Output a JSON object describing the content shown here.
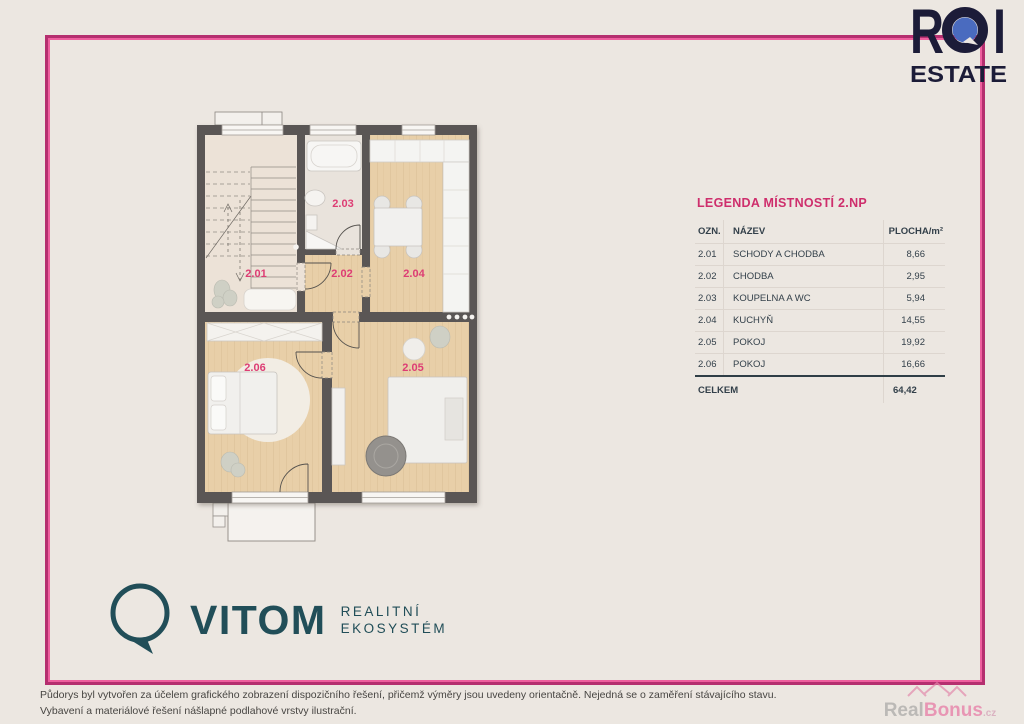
{
  "branding": {
    "roi": {
      "word": "ROI",
      "letter_r": "R",
      "letter_i": "I",
      "line2": "ESTATE"
    },
    "vitom": {
      "name": "VITOM",
      "tagline_line1": "REALITNÍ",
      "tagline_line2": "EKOSYSTÉM"
    },
    "watermark": {
      "part1": "Real",
      "part2": "Bonus",
      "suffix": ".cz"
    }
  },
  "legend": {
    "title": "LEGENDA MÍSTNOSTÍ 2.NP",
    "columns": {
      "code": "OZN.",
      "name": "NÁZEV",
      "area": "PLOCHA/m²"
    },
    "rows": [
      {
        "code": "2.01",
        "name": "SCHODY A CHODBA",
        "area": "8,66"
      },
      {
        "code": "2.02",
        "name": "CHODBA",
        "area": "2,95"
      },
      {
        "code": "2.03",
        "name": "KOUPELNA A WC",
        "area": "5,94"
      },
      {
        "code": "2.04",
        "name": "KUCHYŇ",
        "area": "14,55"
      },
      {
        "code": "2.05",
        "name": "POKOJ",
        "area": "19,92"
      },
      {
        "code": "2.06",
        "name": "POKOJ",
        "area": "16,66"
      }
    ],
    "total_label": "CELKEM",
    "total_value": "64,42"
  },
  "footer": {
    "disclaimer_line1": "Půdorys byl vytvořen za účelem grafického zobrazení dispozičního řešení, přičemž výměry jsou uvedeny orientačně. Nejedná se o zaměření stávajícího stavu.",
    "disclaimer_line2": "Vybavení a materiálové řešení nášlapné podlahové vrstvy ilustrační."
  },
  "colors": {
    "background": "#ece7e1",
    "frame_outer_pink": "#b52f6f",
    "frame_inner_pink": "#ee5f9e",
    "accent_pink": "#ce2e6c",
    "room_label_pink": "#dd3d74",
    "wall_gray": "#5a5754",
    "wood_floor": "#e8cfa8",
    "logo_navy": "#1c1c38",
    "logo_blue": "#4a6bbf",
    "logo_teal": "#214e58"
  }
}
